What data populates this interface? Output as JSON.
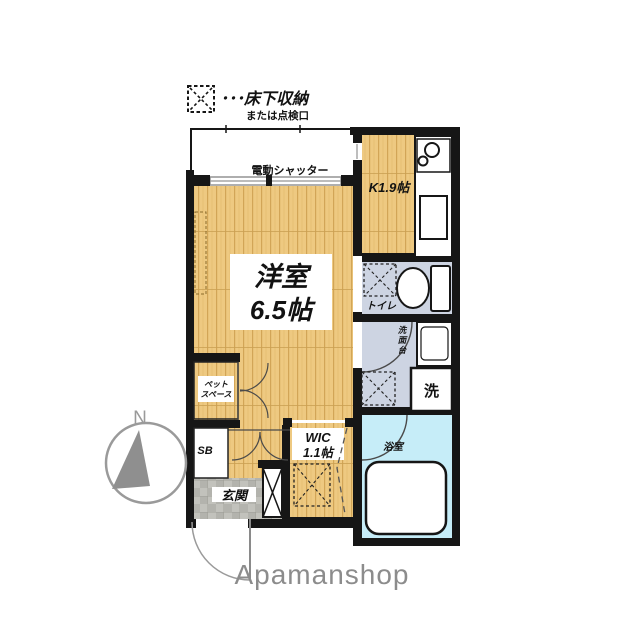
{
  "legend": {
    "icon": "underfloor-storage-symbol",
    "label": "･･･床下収納",
    "sublabel": "または点検口"
  },
  "rooms": {
    "shutter": {
      "label": "電動シャッター"
    },
    "kitchen": {
      "label": "K1.9帖"
    },
    "main": {
      "name": "洋室",
      "size": "6.5帖"
    },
    "toilet": {
      "label": "トイレ"
    },
    "washbasin": {
      "chars": [
        "洗",
        "面",
        "台"
      ]
    },
    "washer": {
      "label": "洗"
    },
    "bathroom": {
      "label": "浴室"
    },
    "wic": {
      "name": "WIC",
      "size": "1.1帖"
    },
    "petspace": {
      "line1": "ペット",
      "line2": "スペース"
    },
    "shoebox": {
      "label": "SB"
    },
    "entrance": {
      "label": "玄関"
    }
  },
  "compass": {
    "north": "N"
  },
  "brand": {
    "label": "Apamanshop"
  },
  "colors": {
    "wall": "#161616",
    "wood_floor": "#eec981",
    "wet_area_floor": "#cdd4e2",
    "bathroom_floor": "#c6edf8",
    "entrance_tile": "#b3b3ad",
    "brand_gray": "#8c8c8c",
    "compass_gray": "#9a9a9a"
  }
}
